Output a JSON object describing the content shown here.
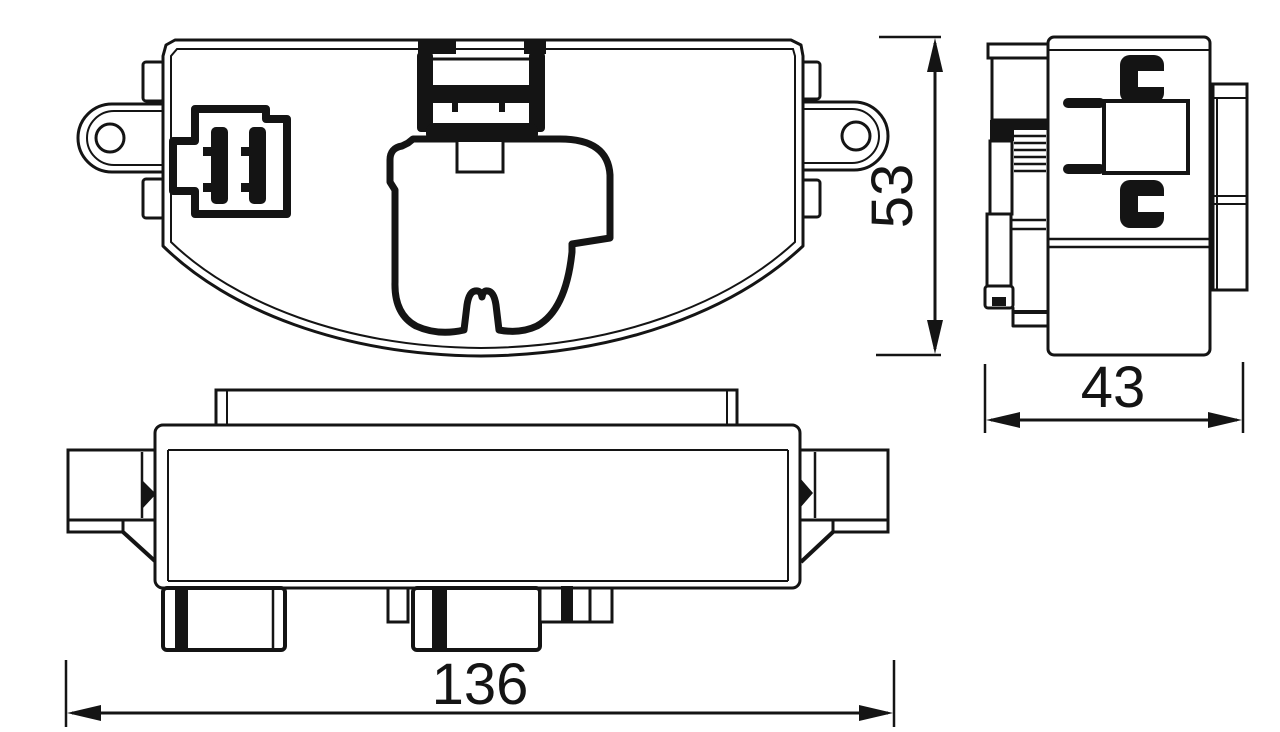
{
  "drawing": {
    "kind": "technical-drawing",
    "background_color": "#ffffff",
    "line_color": "#141414"
  },
  "dimensions": {
    "length": "136",
    "height": "53",
    "depth": "43"
  }
}
